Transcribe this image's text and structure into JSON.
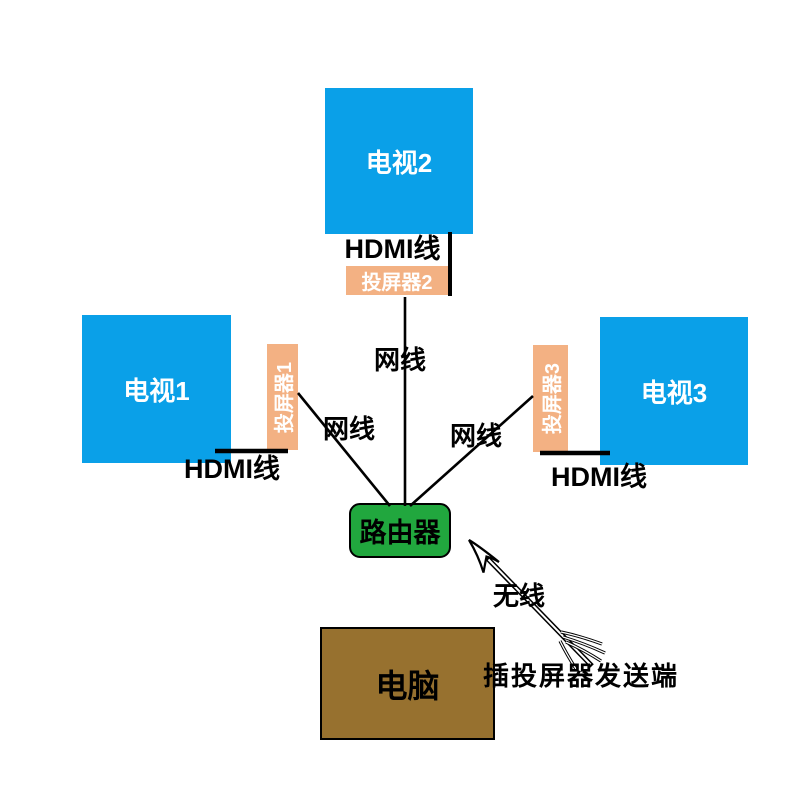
{
  "colors": {
    "background": "#ffffff",
    "tv": "#0aa0e8",
    "caster": "#f3b183",
    "router": "#21a73e",
    "computer": "#97712f",
    "line": "#000000",
    "tv-label": "#ffffff",
    "caster-label": "#ffffff",
    "text": "#000000"
  },
  "nodes": {
    "tv1": {
      "label": "电视1"
    },
    "tv2": {
      "label": "电视2"
    },
    "tv3": {
      "label": "电视3"
    },
    "caster1": {
      "label": "投屏器1"
    },
    "caster2": {
      "label": "投屏器2"
    },
    "caster3": {
      "label": "投屏器3"
    },
    "router": {
      "label": "路由器"
    },
    "computer": {
      "label": "电脑"
    }
  },
  "edges": {
    "hdmi1": {
      "label": "HDMI线",
      "type": "hdmi-cable"
    },
    "hdmi2": {
      "label": "HDMI线",
      "type": "hdmi-cable"
    },
    "hdmi3": {
      "label": "HDMI线",
      "type": "hdmi-cable"
    },
    "lan1": {
      "label": "网线",
      "type": "network-cable"
    },
    "lan2": {
      "label": "网线",
      "type": "network-cable"
    },
    "lan3": {
      "label": "网线",
      "type": "network-cable"
    },
    "wireless": {
      "label": "无线",
      "type": "wireless"
    }
  },
  "annotations": {
    "sender": "插投屏器发送端"
  }
}
